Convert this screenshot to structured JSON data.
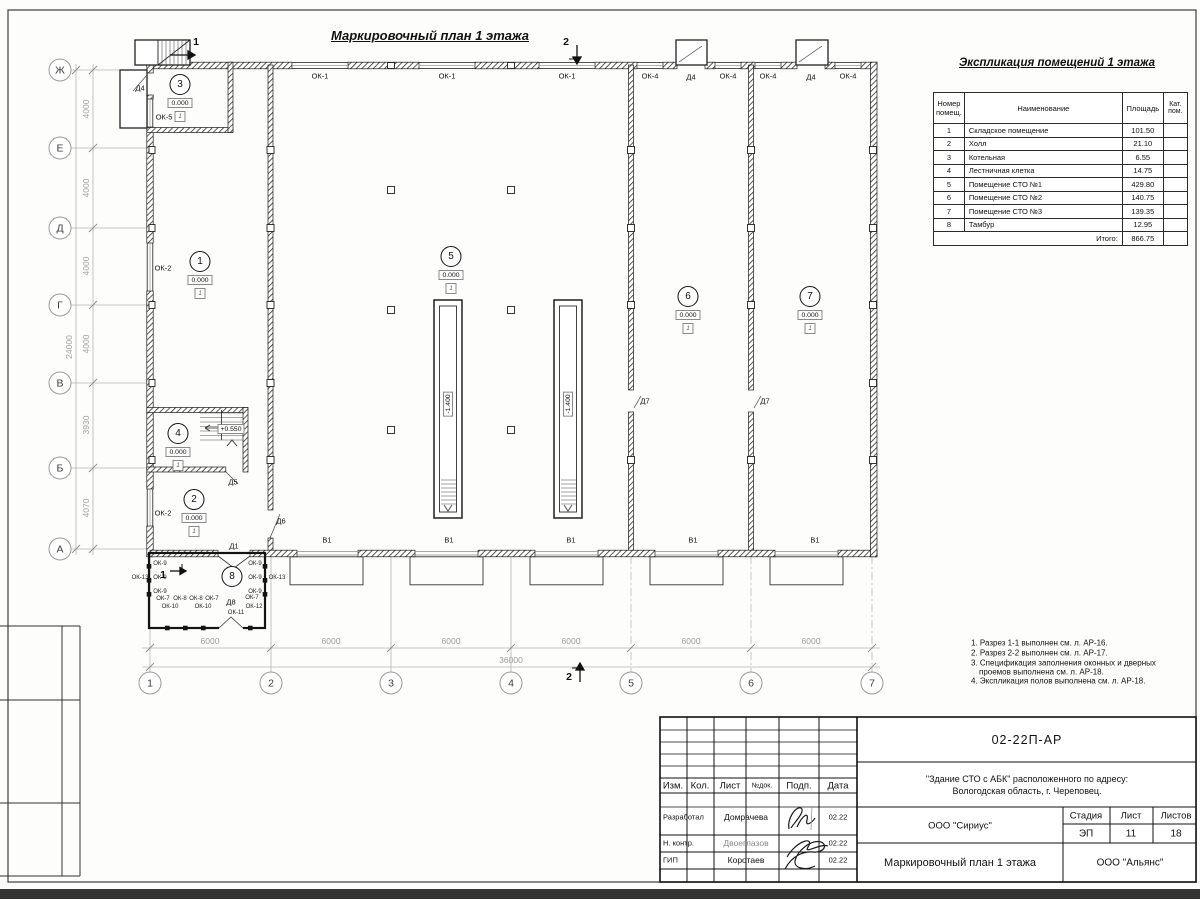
{
  "sheet": {
    "plan_title": "Маркировочный план 1 этажа"
  },
  "plan": {
    "bubbles": [
      {
        "t": "Ж",
        "x": 60,
        "y": 70
      },
      {
        "t": "Е",
        "x": 60,
        "y": 148
      },
      {
        "t": "Д",
        "x": 60,
        "y": 228
      },
      {
        "t": "Г",
        "x": 60,
        "y": 305
      },
      {
        "t": "В",
        "x": 60,
        "y": 383
      },
      {
        "t": "Б",
        "x": 60,
        "y": 468
      },
      {
        "t": "А",
        "x": 60,
        "y": 549
      },
      {
        "t": "1",
        "x": 150,
        "y": 683
      },
      {
        "t": "2",
        "x": 271,
        "y": 683
      },
      {
        "t": "3",
        "x": 391,
        "y": 683
      },
      {
        "t": "4",
        "x": 511,
        "y": 683
      },
      {
        "t": "5",
        "x": 631,
        "y": 683
      },
      {
        "t": "6",
        "x": 751,
        "y": 683
      },
      {
        "t": "7",
        "x": 872,
        "y": 683
      }
    ],
    "dim_labels": [
      {
        "t": "4000",
        "x": 86,
        "y": 109,
        "r": -90
      },
      {
        "t": "4000",
        "x": 86,
        "y": 188,
        "r": -90
      },
      {
        "t": "4000",
        "x": 86,
        "y": 266,
        "r": -90
      },
      {
        "t": "4000",
        "x": 86,
        "y": 344,
        "r": -90
      },
      {
        "t": "3930",
        "x": 86,
        "y": 425,
        "r": -90
      },
      {
        "t": "4070",
        "x": 86,
        "y": 508,
        "r": -90
      },
      {
        "t": "24000",
        "x": 69,
        "y": 347,
        "r": -90
      },
      {
        "t": "6000",
        "x": 210,
        "y": 641
      },
      {
        "t": "6000",
        "x": 331,
        "y": 641
      },
      {
        "t": "6000",
        "x": 451,
        "y": 641
      },
      {
        "t": "6000",
        "x": 571,
        "y": 641
      },
      {
        "t": "6000",
        "x": 691,
        "y": 641
      },
      {
        "t": "6000",
        "x": 811,
        "y": 641
      },
      {
        "t": "36000",
        "x": 511,
        "y": 660
      }
    ],
    "labels": [
      {
        "t": "ОК-1",
        "x": 320,
        "y": 76
      },
      {
        "t": "ОК-1",
        "x": 447,
        "y": 76
      },
      {
        "t": "ОК-1",
        "x": 567,
        "y": 76
      },
      {
        "t": "ОК-4",
        "x": 650,
        "y": 76
      },
      {
        "t": "Д4",
        "x": 691,
        "y": 77
      },
      {
        "t": "ОК-4",
        "x": 728,
        "y": 76
      },
      {
        "t": "ОК-4",
        "x": 768,
        "y": 76
      },
      {
        "t": "Д4",
        "x": 811,
        "y": 77
      },
      {
        "t": "ОК-4",
        "x": 848,
        "y": 76
      },
      {
        "t": "Д4",
        "x": 140,
        "y": 88
      },
      {
        "t": "ОК-5",
        "x": 164,
        "y": 117
      },
      {
        "t": "ОК-2",
        "x": 163,
        "y": 268
      },
      {
        "t": "ОК-2",
        "x": 163,
        "y": 513
      },
      {
        "t": "Д5",
        "x": 233,
        "y": 482
      },
      {
        "t": "Д6",
        "x": 281,
        "y": 521
      },
      {
        "t": "Д1",
        "x": 234,
        "y": 546
      },
      {
        "t": "Д8",
        "x": 231,
        "y": 602
      },
      {
        "t": "Д7",
        "x": 645,
        "y": 401
      },
      {
        "t": "Д7",
        "x": 765,
        "y": 401
      },
      {
        "t": "В1",
        "x": 327,
        "y": 540
      },
      {
        "t": "В1",
        "x": 449,
        "y": 540
      },
      {
        "t": "В1",
        "x": 571,
        "y": 540
      },
      {
        "t": "В1",
        "x": 693,
        "y": 540
      },
      {
        "t": "В1",
        "x": 815,
        "y": 540
      }
    ],
    "small_labels": [
      {
        "t": "ОК-9",
        "x": 160,
        "y": 564
      },
      {
        "t": "ОК-9",
        "x": 160,
        "y": 578
      },
      {
        "t": "ОК-9",
        "x": 160,
        "y": 592
      },
      {
        "t": "ОК-9",
        "x": 255,
        "y": 564
      },
      {
        "t": "ОК-9",
        "x": 255,
        "y": 578
      },
      {
        "t": "ОК-9",
        "x": 255,
        "y": 592
      },
      {
        "t": "ОК-13",
        "x": 140,
        "y": 578
      },
      {
        "t": "ОК-13",
        "x": 277,
        "y": 578
      },
      {
        "t": "ОК-7",
        "x": 163,
        "y": 599
      },
      {
        "t": "ОК-8",
        "x": 180,
        "y": 599
      },
      {
        "t": "ОК-8",
        "x": 196,
        "y": 599
      },
      {
        "t": "ОК-7",
        "x": 212,
        "y": 599
      },
      {
        "t": "ОК-7",
        "x": 252,
        "y": 598
      },
      {
        "t": "ОК-10",
        "x": 170,
        "y": 607
      },
      {
        "t": "ОК-10",
        "x": 203,
        "y": 607
      },
      {
        "t": "ОК-11",
        "x": 236,
        "y": 613
      },
      {
        "t": "ОК-12",
        "x": 254,
        "y": 607
      }
    ],
    "rooms": [
      {
        "n": "1",
        "x": 200,
        "y": 262,
        "elev": "0.000",
        "floor": "1"
      },
      {
        "n": "2",
        "x": 194,
        "y": 500,
        "elev": "0.000",
        "floor": "1"
      },
      {
        "n": "3",
        "x": 180,
        "y": 85,
        "elev": "0.000",
        "floor": "1"
      },
      {
        "n": "4",
        "x": 178,
        "y": 434,
        "elev": "0.000",
        "floor": "1"
      },
      {
        "n": "5",
        "x": 451,
        "y": 257,
        "elev": "0.000",
        "floor": "1"
      },
      {
        "n": "6",
        "x": 688,
        "y": 297,
        "elev": "0.000",
        "floor": "1"
      },
      {
        "n": "7",
        "x": 810,
        "y": 297,
        "elev": "0.000",
        "floor": "1"
      },
      {
        "n": "8",
        "x": 232,
        "y": 577
      }
    ],
    "elev_marks": [
      {
        "t": "+0.550",
        "x": 231,
        "y": 429
      },
      {
        "t": "-1.400",
        "x": 448,
        "y": 404,
        "r": -90
      },
      {
        "t": "-1.400",
        "x": 568,
        "y": 404,
        "r": -90
      }
    ],
    "sections": [
      {
        "t": "1",
        "x": 196,
        "y": 42
      },
      {
        "t": "2",
        "x": 566,
        "y": 42
      },
      {
        "t": "2",
        "x": 569,
        "y": 677
      },
      {
        "t": "1",
        "x": 163,
        "y": 575
      }
    ]
  },
  "explication": {
    "title": "Экспликация помещений 1 этажа",
    "headers": [
      "Номер помещ.",
      "Наименование",
      "Площадь",
      "Кат. пом."
    ],
    "rows": [
      {
        "num": "1",
        "name": "Складское помещение",
        "area": "101.50"
      },
      {
        "num": "2",
        "name": "Холл",
        "area": "21.10"
      },
      {
        "num": "3",
        "name": "Котельная",
        "area": "6.55"
      },
      {
        "num": "4",
        "name": "Лестничная клетка",
        "area": "14.75"
      },
      {
        "num": "5",
        "name": "Помещение СТО №1",
        "area": "429.80"
      },
      {
        "num": "6",
        "name": "Помещение СТО №2",
        "area": "140.75"
      },
      {
        "num": "7",
        "name": "Помещение СТО №3",
        "area": "139.35"
      },
      {
        "num": "8",
        "name": "Тамбур",
        "area": "12.95"
      }
    ],
    "total_label": "Итого:",
    "total": "866.75"
  },
  "notes": {
    "lines": [
      {
        "t": "1. Разрез 1-1 выполнен см. л. АР-16.",
        "x": 971,
        "y": 643
      },
      {
        "t": "2. Разрез 2-2 выполнен см. л. АР-17.",
        "x": 971,
        "y": 653
      },
      {
        "t": "3. Спецификация заполнения оконных и дверных",
        "x": 971,
        "y": 663
      },
      {
        "t": "проемов выполнена см. л. АР-18.",
        "x": 979,
        "y": 672
      },
      {
        "t": "4. Экспликация полов выполнена см. л. АР-18.",
        "x": 971,
        "y": 681
      }
    ]
  },
  "titleblock": {
    "doc_number": "02-22П-АР",
    "project_line1": "\"Здание СТО с АБК\" расположенного по адресу:",
    "project_line2": "Вологодская область, г. Череповец.",
    "designer_org": "ООО \"Сириус\"",
    "stage_label": "Стадия",
    "sheet_label": "Лист",
    "sheets_label": "Листов",
    "stage": "ЭП",
    "sheet": "11",
    "sheets": "18",
    "drawing_title": "Маркировочный план 1 этажа",
    "contractor_org": "ООО \"Альянс\"",
    "cols": {
      "izm": "Изм.",
      "kol": "Кол.",
      "list": "Лист",
      "ndok": "№док.",
      "podp": "Подп.",
      "data": "Дата"
    },
    "rows": [
      {
        "role": "Разработал",
        "name": "Домрачева",
        "date": "02.22"
      },
      {
        "role": "Н. контр.",
        "name": "Двоеглазов",
        "date": "02.22"
      },
      {
        "role": "ГИП",
        "name": "Коротаев",
        "date": "02.22"
      }
    ]
  }
}
